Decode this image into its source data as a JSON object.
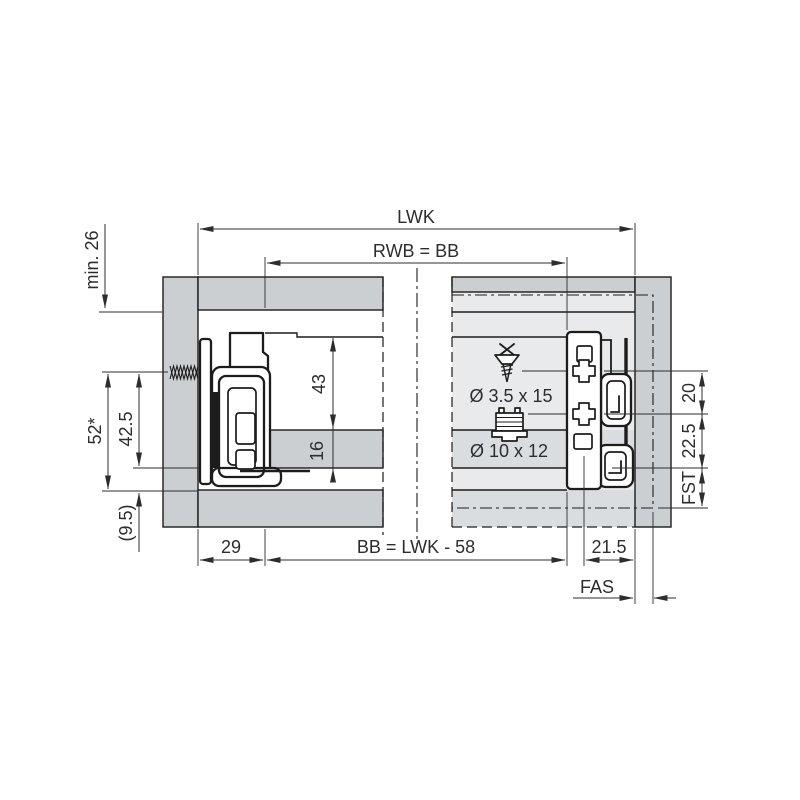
{
  "drawing": {
    "type": "technical-installation-drawing",
    "dimensions": {
      "lwk": "LWK",
      "rwb_bb": "RWB = BB",
      "min_26": "min. 26",
      "h52": "52*",
      "h42_5": "42.5",
      "h9_5": "(9.5)",
      "h43": "43",
      "h16": "16",
      "w29": "29",
      "bb_formula": "BB = LWK - 58",
      "w21_5": "21.5",
      "fas": "FAS",
      "fst": "FST",
      "h22_5": "22.5",
      "h20": "20"
    },
    "hardware": {
      "front_screw": "Ø 3.5 x 15",
      "euro_dowel": "Ø 10 x 12"
    },
    "colors": {
      "panel": "#cbcfd2",
      "phantom": "#e8eaec",
      "phantom_band": "#dadde0",
      "line": "#1c1c1c",
      "dim": "#2d2d2d",
      "background": "#ffffff"
    }
  }
}
